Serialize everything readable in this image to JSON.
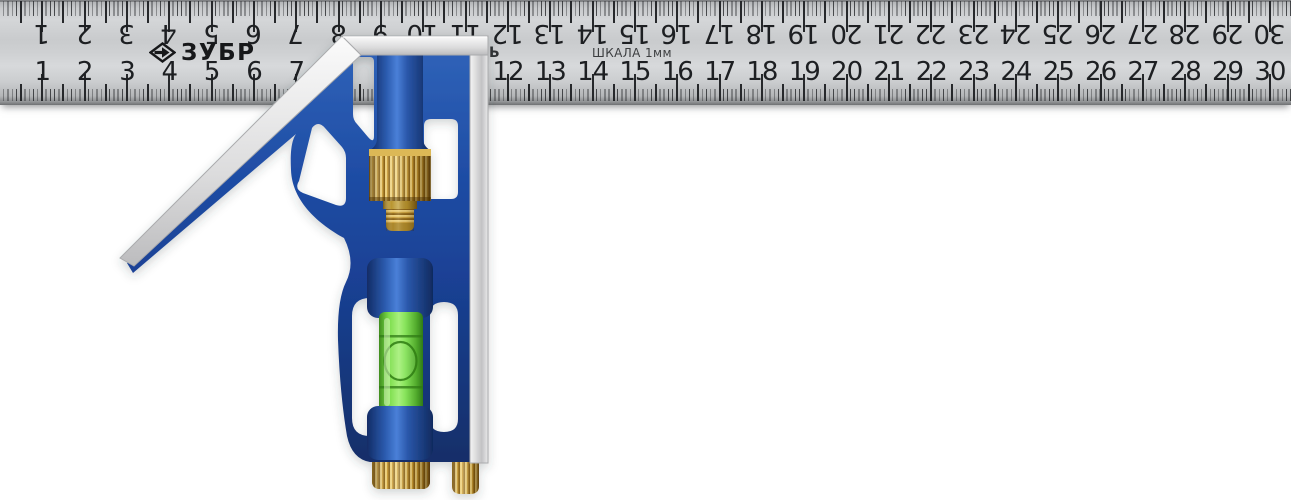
{
  "ruler": {
    "brand": "ЗУБР",
    "brand_icon": "zubr-diamond-arrow-icon",
    "scale_label": "ШКАЛА 1мм",
    "edge_text_fragment": "Ь",
    "cm_max": 30,
    "cm_numbers": [
      1,
      2,
      3,
      4,
      5,
      6,
      7,
      8,
      9,
      10,
      11,
      12,
      13,
      14,
      15,
      16,
      17,
      18,
      19,
      20,
      21,
      22,
      23,
      24,
      25,
      26,
      27,
      28,
      29,
      30
    ],
    "colors": {
      "steel_face": "#ced0d2",
      "steel_edge_dark": "#787a7c",
      "markings": "#26282b"
    }
  },
  "square_head": {
    "parts": {
      "angle_face_45": "45-degree machined face",
      "top_face": "machined top face",
      "right_face": "machined 90-degree face",
      "lock_nut": "brass knurled lock nut",
      "threaded_stud": "brass threaded stud",
      "level_vial": "spirit level vial",
      "bubble": "level bubble",
      "thumb_wheel": "brass thumb wheel",
      "scriber_pin": "brass scriber pin"
    },
    "colors": {
      "body_blue": "#1e4da3",
      "body_blue_dark": "#122e69",
      "body_blue_light": "#4a80d8",
      "machined_silver": "#e6e6e8",
      "brass": "#c79a35",
      "brass_light": "#ecd07c",
      "brass_dark": "#8a6318",
      "vial_green": "#86e35a",
      "vial_green_dark": "#2f7a16"
    }
  }
}
